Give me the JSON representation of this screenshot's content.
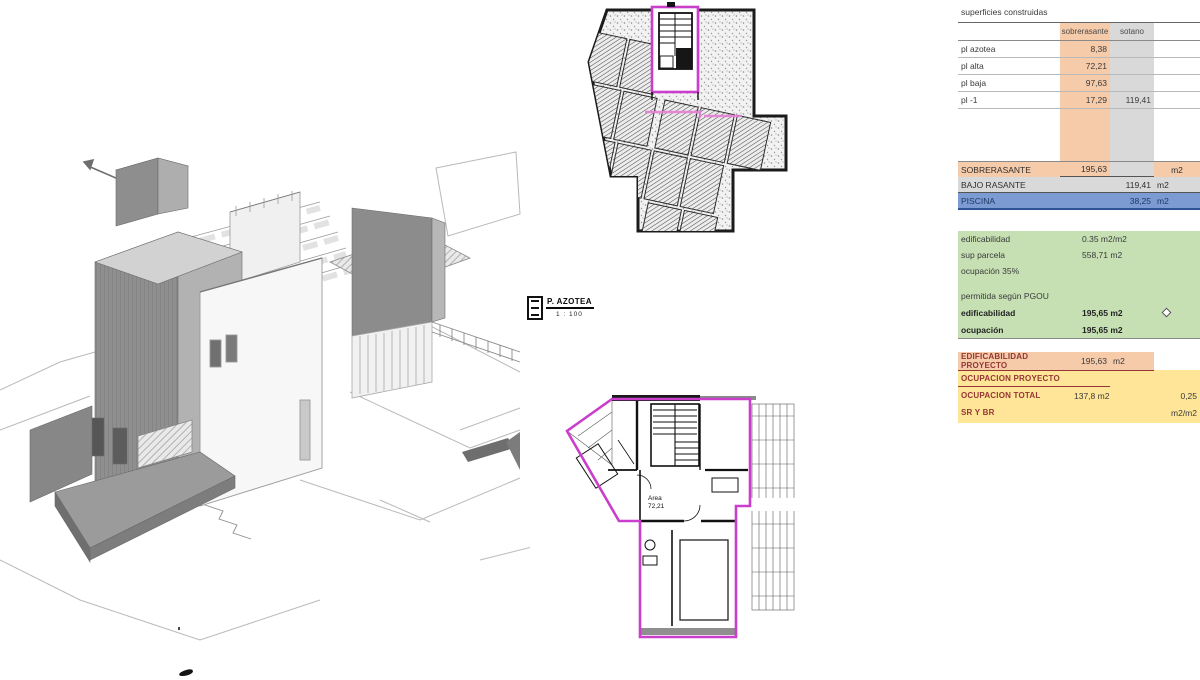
{
  "legend": {
    "title": "P. AZOTEA",
    "scale": "1 : 100"
  },
  "floor_plan": {
    "area_label": "Area",
    "area_value": "72,21"
  },
  "table": {
    "title": "superficies construidas",
    "col_headers": {
      "col1": "sobrerasante",
      "col2": "sotano"
    },
    "floors": [
      {
        "label": "pl azotea",
        "sobrerasante": "8,38",
        "sotano": ""
      },
      {
        "label": "pl alta",
        "sobrerasante": "72,21",
        "sotano": ""
      },
      {
        "label": "pl baja",
        "sobrerasante": "97,63",
        "sotano": ""
      },
      {
        "label": "pl -1",
        "sobrerasante": "17,29",
        "sotano": "119,41"
      }
    ],
    "totals": [
      {
        "label": "SOBRERASANTE",
        "value": "195,63",
        "unit": "m2"
      },
      {
        "label": "BAJO RASANTE",
        "value": "119,41",
        "unit": "m2"
      },
      {
        "label": "PISCINA",
        "value": "38,25",
        "unit": "m2"
      }
    ],
    "normativa": {
      "rows": [
        {
          "label": "edificabilidad",
          "value": "0.35 m2/m2"
        },
        {
          "label": "sup parcela",
          "value": "558,71 m2"
        },
        {
          "label": "ocupación 35%",
          "value": ""
        },
        {
          "label": "permitida según PGOU",
          "value": ""
        },
        {
          "label": "edificabilidad",
          "value": "195,65 m2"
        },
        {
          "label": "ocupación",
          "value": "195,65 m2"
        }
      ]
    },
    "proyecto": {
      "rows": [
        {
          "label": "EDIFICABILIDAD PROYECTO",
          "value": "195,63",
          "unit": "m2",
          "extra": ""
        },
        {
          "label": "OCUPACION PROYECTO",
          "value": "",
          "unit": "",
          "extra": ""
        },
        {
          "label": "OCUPACION TOTAL",
          "value": "137,8 m2",
          "unit": "",
          "extra": "0,25"
        },
        {
          "label": "SR Y BR",
          "value": "",
          "unit": "",
          "extra": "m2/m2"
        }
      ]
    }
  },
  "colors": {
    "orange": "#F6CBAA",
    "gray": "#D9D9D9",
    "blue": "#7B9BD2",
    "blue-dark": "#2F5496",
    "blue-text": "#1F3864",
    "green": "#C6E0B4",
    "yellow": "#FFE598",
    "darkred": "#943634",
    "magenta": "#C93ECB",
    "pink": "#E87FD5"
  }
}
